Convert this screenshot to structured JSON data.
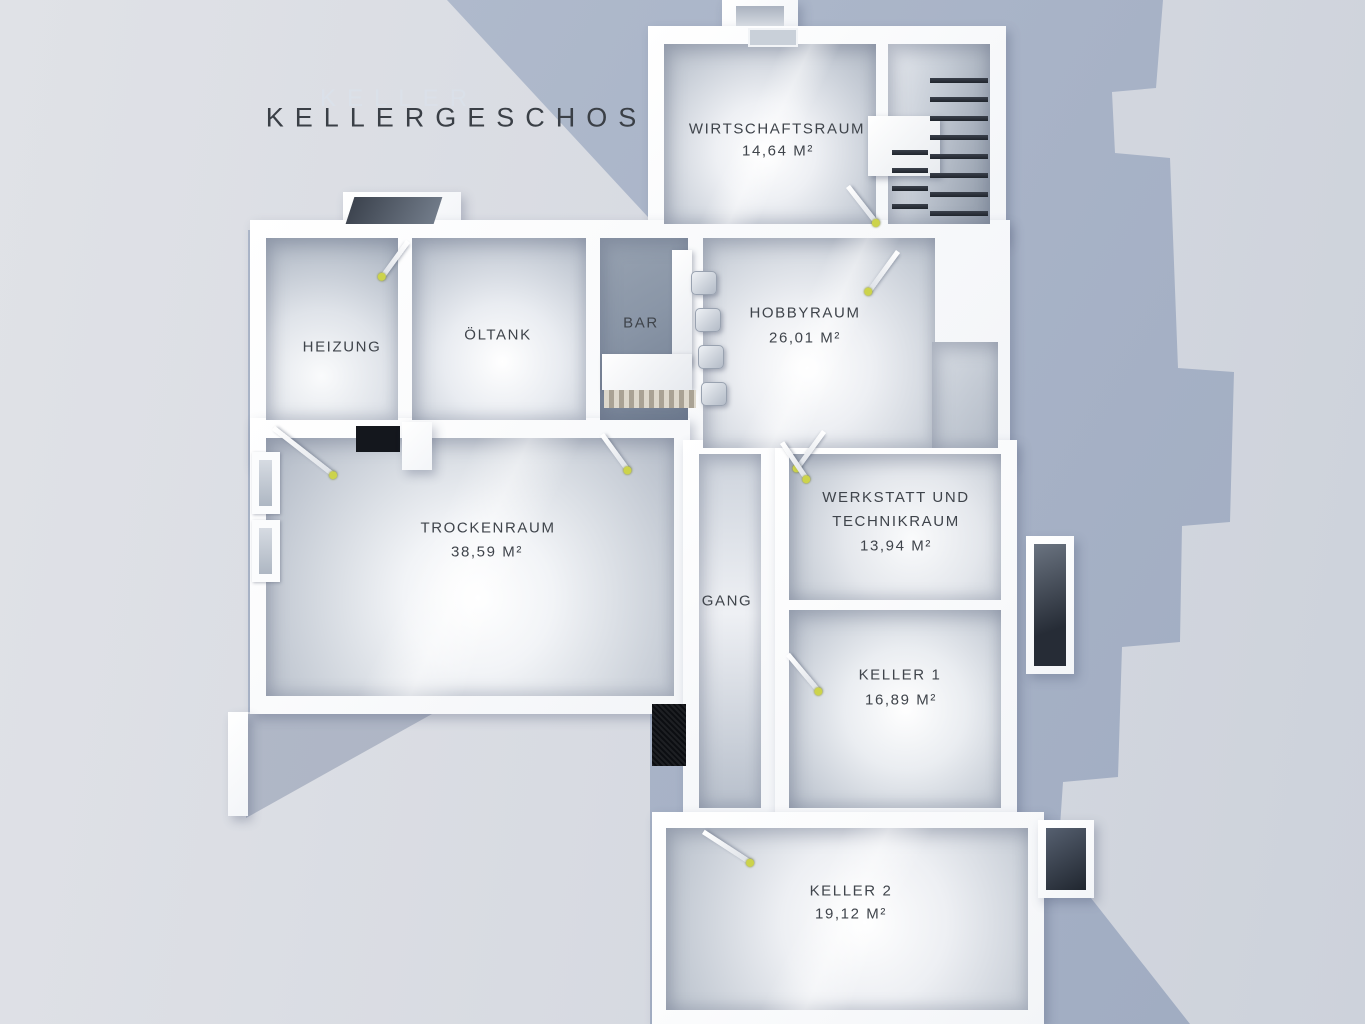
{
  "title": {
    "text": "KELLERGESCHOSS",
    "ghost": "KELLER"
  },
  "rooms": [
    {
      "id": "wirtschaftsraum",
      "name": "WIRTSCHAFTSRAUM",
      "area": "14,64 M²"
    },
    {
      "id": "heizung",
      "name": "HEIZUNG",
      "area": ""
    },
    {
      "id": "oeltank",
      "name": "ÖLTANK",
      "area": ""
    },
    {
      "id": "bar",
      "name": "BAR",
      "area": ""
    },
    {
      "id": "hobbyraum",
      "name": "HOBBYRAUM",
      "area": "26,01 M²"
    },
    {
      "id": "trockenraum",
      "name": "TROCKENRAUM",
      "area": "38,59 M²"
    },
    {
      "id": "werkstatt",
      "name": "WERKSTATT UND TECHNIKRAUM",
      "area": "13,94 M²"
    },
    {
      "id": "gang",
      "name": "GANG",
      "area": ""
    },
    {
      "id": "keller1",
      "name": "KELLER 1",
      "area": "16,89 M²"
    },
    {
      "id": "keller2",
      "name": "KELLER 2",
      "area": "19,12 M²"
    }
  ],
  "colors": {
    "label": "#3f444b",
    "handle": "#ccd34b",
    "wall": "#fbfcfd",
    "shadow": "#a8b3c7",
    "background": "#d8dbe2",
    "bar_floor": "#8290a3"
  }
}
